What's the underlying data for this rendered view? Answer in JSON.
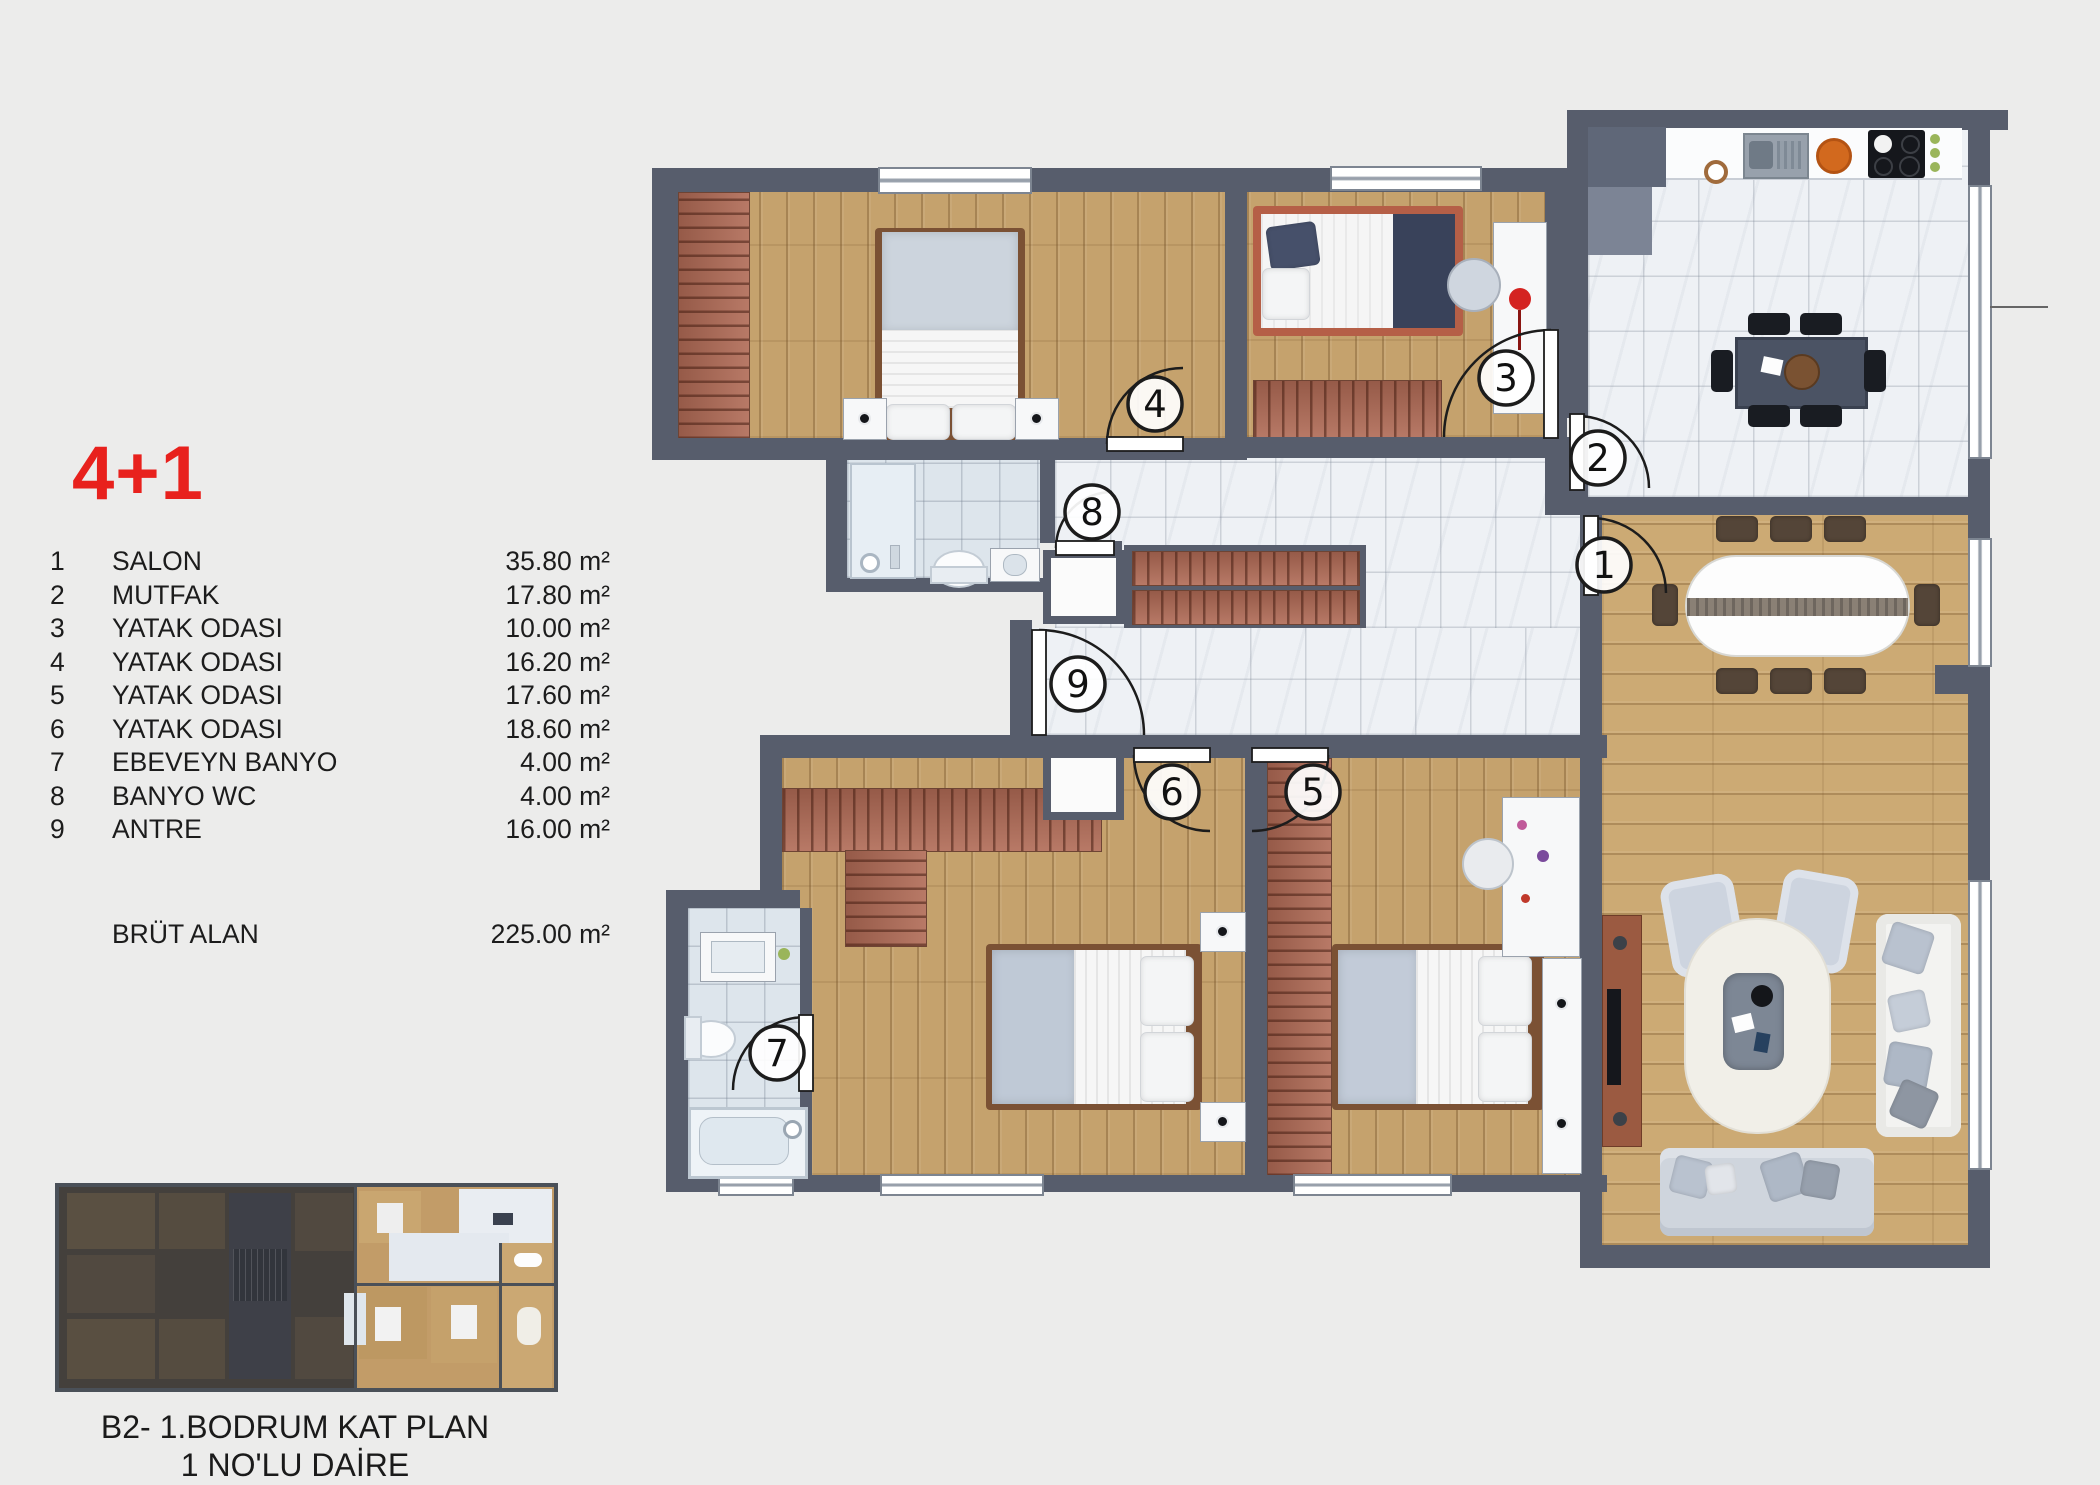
{
  "panel": {
    "title": "4+1",
    "legend": [
      {
        "no": "1",
        "name": "SALON",
        "area": "35.80 m²"
      },
      {
        "no": "2",
        "name": "MUTFAK",
        "area": "17.80 m²"
      },
      {
        "no": "3",
        "name": "YATAK ODASI",
        "area": "10.00 m²"
      },
      {
        "no": "4",
        "name": "YATAK ODASI",
        "area": "16.20 m²"
      },
      {
        "no": "5",
        "name": "YATAK ODASI",
        "area": "17.60 m²"
      },
      {
        "no": "6",
        "name": "YATAK ODASI",
        "area": "18.60 m²"
      },
      {
        "no": "7",
        "name": "EBEVEYN BANYO",
        "area": "4.00 m²"
      },
      {
        "no": "8",
        "name": "BANYO WC",
        "area": "4.00 m²"
      },
      {
        "no": "9",
        "name": "ANTRE",
        "area": "16.00 m²"
      }
    ],
    "total_label": "BRÜT ALAN",
    "total_value": "225.00 m²",
    "caption_line1": "B2- 1.BODRUM KAT PLAN",
    "caption_line2": "1 NO'LU DAİRE"
  },
  "plan": {
    "door_labels": [
      "1",
      "2",
      "3",
      "4",
      "5",
      "6",
      "7",
      "8",
      "9"
    ],
    "colors": {
      "accent_red": "#e8211d",
      "wall": "#575d6c",
      "wood": "#c6a26e",
      "marble": "#eef1f5",
      "brick": "#b06a55"
    }
  }
}
